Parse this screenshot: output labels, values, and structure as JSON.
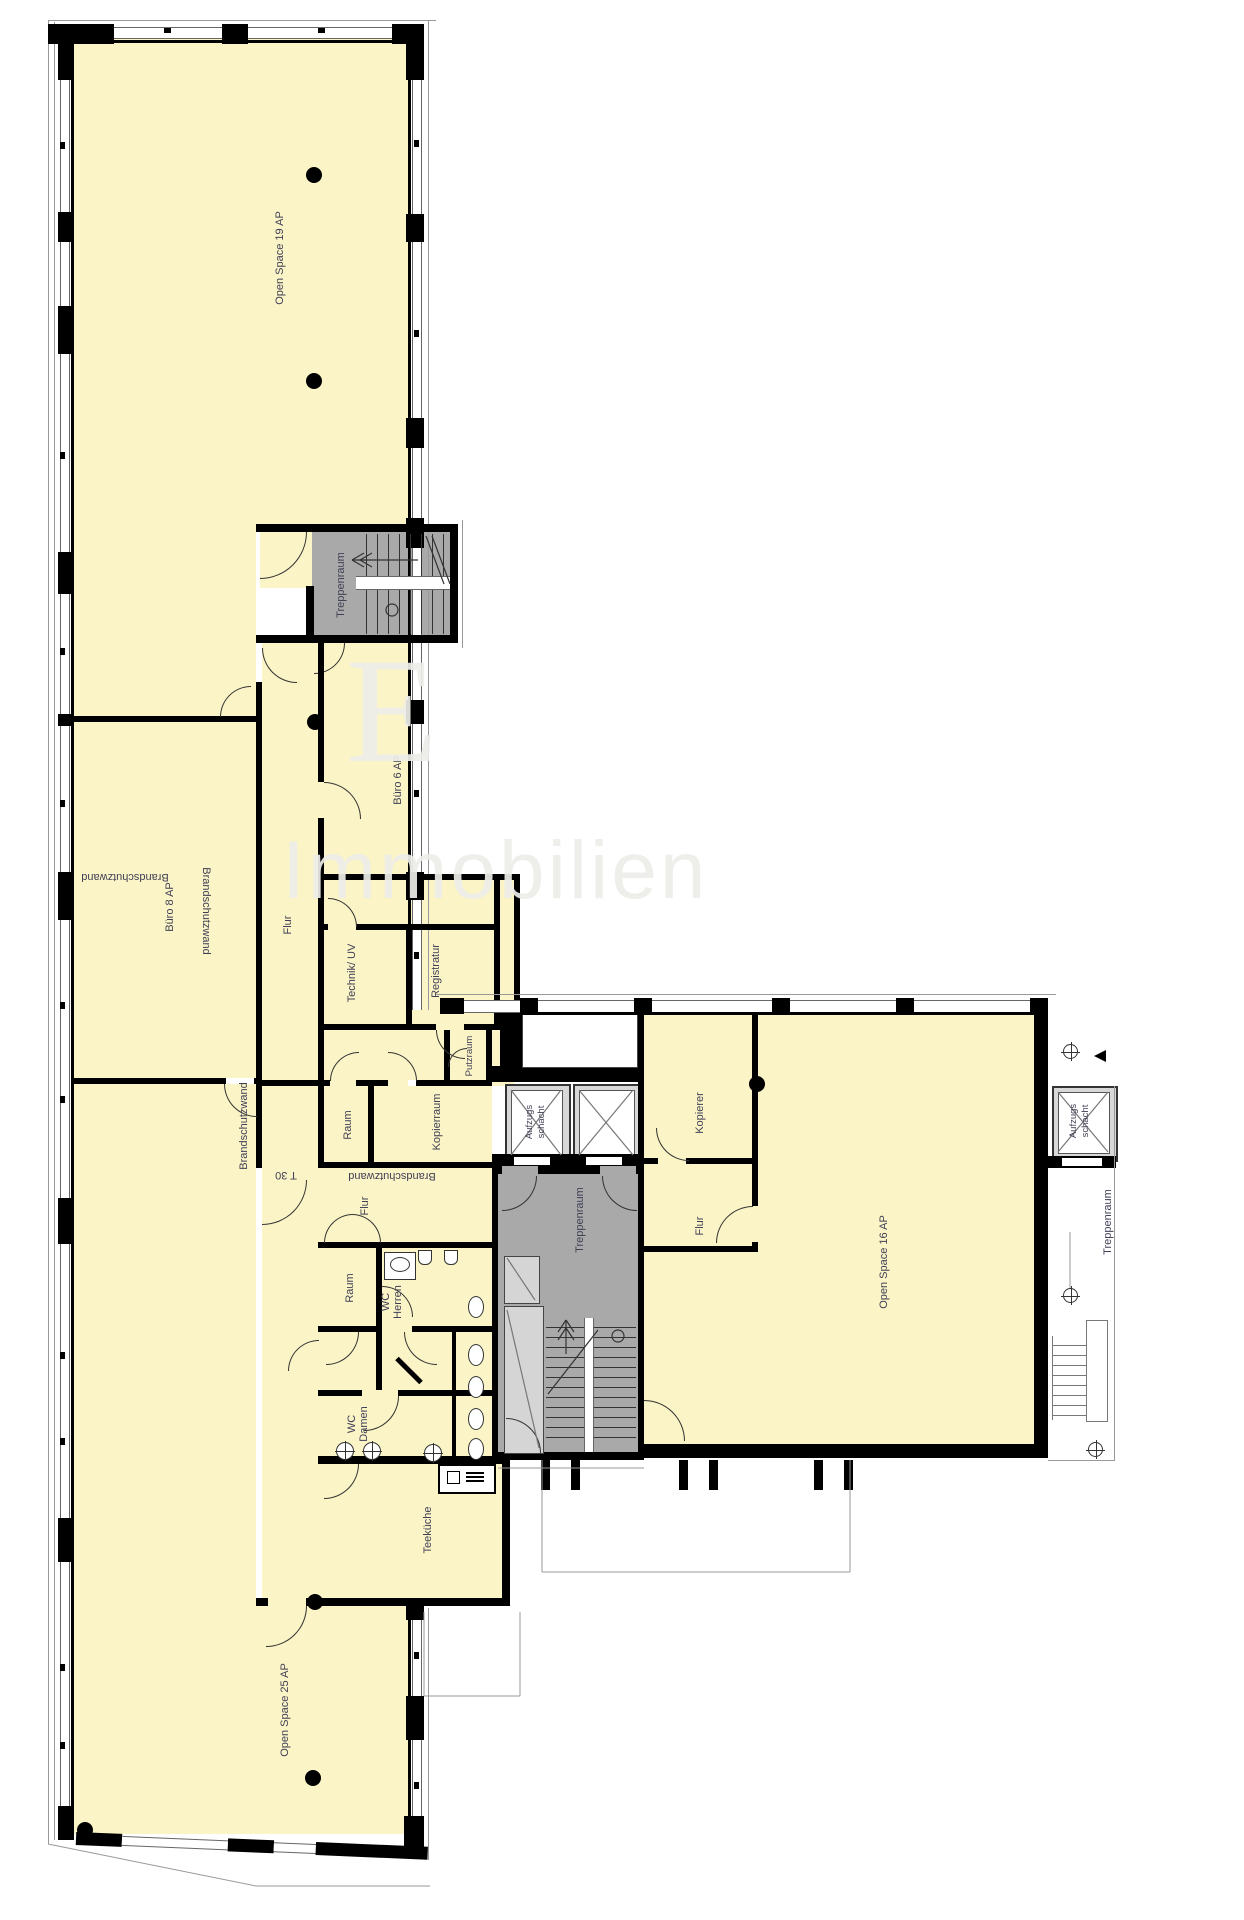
{
  "labels": {
    "os19": "Open Space 19 AP",
    "trep1": "Treppenraum",
    "b6": "Büro 6 AP",
    "b8": "Büro 8 AP",
    "flur_w": "Flur",
    "tech": "Technik/ UV",
    "reg": "Registratur",
    "putz": "Putzraum",
    "raum1": "Raum",
    "kop1": "Kopierraum",
    "afz1": "Aufzugs\nschacht",
    "bsw_core_v": "Brandschutzwand",
    "bsw_core_h": "Brandschutzwand",
    "bsw_west": "Brandschutzwand",
    "bsw_mid_v": "Brandschutzwand",
    "t30": "T 30",
    "flur_m": "Flur",
    "trep2": "Treppenraum",
    "kop2": "Kopierer",
    "flur_e": "Flur",
    "os16": "Open Space 16 AP",
    "afz2": "Aufzugs\nschacht",
    "trep3": "Treppenraum",
    "raum2": "Raum",
    "wc_herren": "WC\nHerren",
    "wc_damen": "WC\nDamen",
    "teek": "Teeküche",
    "os25": "Open Space 25 AP"
  },
  "watermark": {
    "letter": "E",
    "word": "Immobilien"
  },
  "colors": {
    "room_fill": "#FBF4C6",
    "stairwell_fill": "#A9A9A9",
    "shaft_fill": "#D8D8D8",
    "wall": "#000000",
    "label_text": "#3f3f55"
  }
}
